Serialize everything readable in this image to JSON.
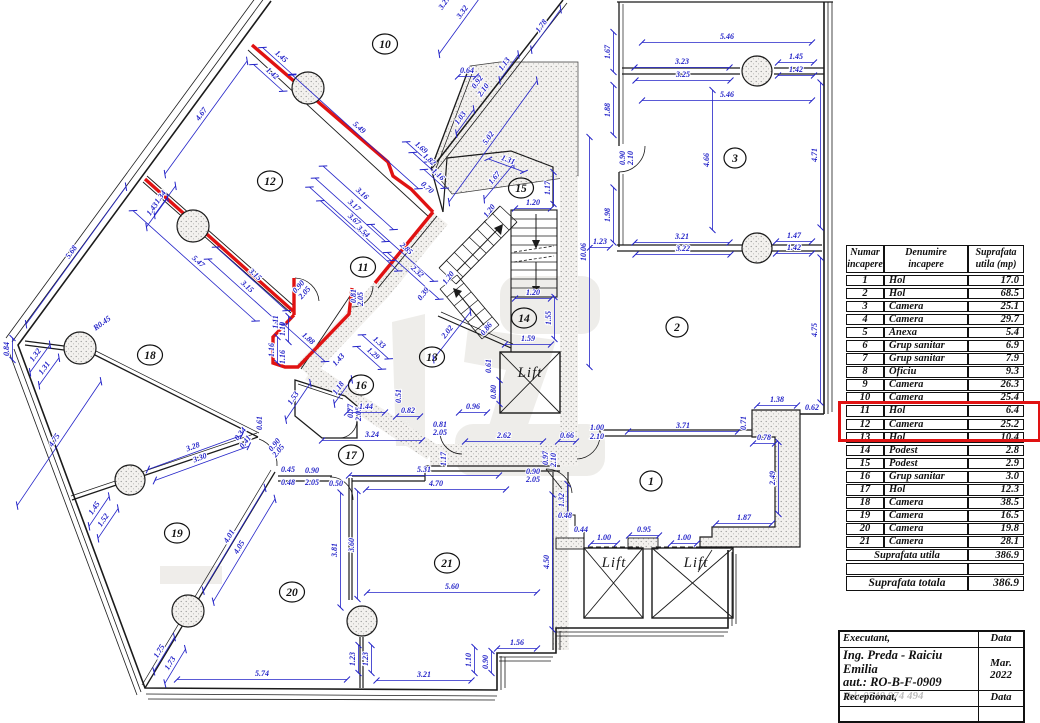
{
  "colors": {
    "wall": "#1b1b1b",
    "dimension_blue": "#2323c8",
    "highlight_red": "#e01212",
    "stipple_gray": "#909090"
  },
  "plan": {
    "rooms": [
      {
        "n": "1",
        "x": 651,
        "y": 481
      },
      {
        "n": "2",
        "x": 677,
        "y": 327
      },
      {
        "n": "3",
        "x": 735,
        "y": 158
      },
      {
        "n": "10",
        "x": 385,
        "y": 44
      },
      {
        "n": "11",
        "x": 363,
        "y": 267
      },
      {
        "n": "12",
        "x": 270,
        "y": 181
      },
      {
        "n": "13",
        "x": 432,
        "y": 357
      },
      {
        "n": "14",
        "x": 524,
        "y": 318
      },
      {
        "n": "15",
        "x": 521,
        "y": 188
      },
      {
        "n": "16",
        "x": 361,
        "y": 385
      },
      {
        "n": "17",
        "x": 351,
        "y": 455
      },
      {
        "n": "18",
        "x": 150,
        "y": 355
      },
      {
        "n": "19",
        "x": 177,
        "y": 533
      },
      {
        "n": "20",
        "x": 292,
        "y": 592
      },
      {
        "n": "21",
        "x": 447,
        "y": 563
      }
    ],
    "lifts": [
      {
        "label": "Lift",
        "x": 530,
        "y": 377
      },
      {
        "label": "Lift",
        "x": 614,
        "y": 567
      },
      {
        "label": "Lift",
        "x": 696,
        "y": 567
      }
    ],
    "dims": [
      {
        "t": "1.45",
        "x": 279,
        "y": 59,
        "r": 42,
        "l": 40
      },
      {
        "t": "1.42",
        "x": 270,
        "y": 76,
        "r": 42,
        "l": 40
      },
      {
        "t": "4.67",
        "x": 204,
        "y": 116,
        "r": -54,
        "l": 140
      },
      {
        "t": "1.34",
        "x": 163,
        "y": 199,
        "r": -54,
        "l": 36
      },
      {
        "t": "1.43",
        "x": 155,
        "y": 211,
        "r": -54,
        "l": 36
      },
      {
        "t": "5.68",
        "x": 74,
        "y": 254,
        "r": -54,
        "l": 170
      },
      {
        "t": "5.49",
        "x": 357,
        "y": 130,
        "r": 42,
        "l": 170
      },
      {
        "t": "3.16",
        "x": 360,
        "y": 196,
        "r": 42,
        "l": 95
      },
      {
        "t": "3.17",
        "x": 352,
        "y": 208,
        "r": 42,
        "l": 95
      },
      {
        "t": "5.47",
        "x": 196,
        "y": 264,
        "r": 42,
        "l": 165
      },
      {
        "t": "3.15",
        "x": 253,
        "y": 277,
        "r": 42,
        "l": 95
      },
      {
        "t": "3.15",
        "x": 245,
        "y": 289,
        "r": 42,
        "l": 95
      },
      {
        "t": "1.32",
        "x": 38,
        "y": 357,
        "r": -54,
        "l": 34
      },
      {
        "t": "1.31",
        "x": 47,
        "y": 370,
        "r": -54,
        "l": 34
      },
      {
        "t": "0.84",
        "x": 10,
        "y": 349,
        "r": -90,
        "l": 22
      },
      {
        "t": "R0.45",
        "x": 104,
        "y": 326,
        "r": -36,
        "l": 0
      },
      {
        "t": "1.69",
        "x": 419,
        "y": 150,
        "r": 42,
        "l": 30
      },
      {
        "t": "1.82",
        "x": 427,
        "y": 162,
        "r": 42,
        "l": 34
      },
      {
        "t": "1.16",
        "x": 436,
        "y": 177,
        "r": 42,
        "l": 28
      },
      {
        "t": "0.70",
        "x": 425,
        "y": 190,
        "r": 42,
        "l": 0
      },
      {
        "t": "3.67",
        "x": 352,
        "y": 222,
        "r": 42,
        "l": 110
      },
      {
        "t": "3.54",
        "x": 361,
        "y": 234,
        "r": 42,
        "l": 105
      },
      {
        "t": "2.85",
        "x": 404,
        "y": 251,
        "r": 42,
        "l": 85
      },
      {
        "t": "2.32",
        "x": 415,
        "y": 274,
        "r": 42,
        "l": 70
      },
      {
        "t": "1.03",
        "x": 463,
        "y": 120,
        "r": -54,
        "l": 30
      },
      {
        "t": "5.02",
        "x": 491,
        "y": 140,
        "r": -54,
        "l": 150
      },
      {
        "t": "0.92",
        "x": 480,
        "y": 84,
        "r": -54,
        "l": 0
      },
      {
        "t": "2.10",
        "x": 486,
        "y": 92,
        "r": -54,
        "l": 0
      },
      {
        "t": "1.13",
        "x": 507,
        "y": 66,
        "r": -54,
        "l": 32
      },
      {
        "t": "1.78",
        "x": 544,
        "y": 28,
        "r": -54,
        "l": 50
      },
      {
        "t": "3.27",
        "x": 447,
        "y": 5,
        "r": -54,
        "l": 0
      },
      {
        "t": "3.32",
        "x": 465,
        "y": 14,
        "r": -54,
        "l": 95
      },
      {
        "t": "0.64",
        "x": 467,
        "y": 74,
        "r": 0,
        "l": 18
      },
      {
        "t": "1.67",
        "x": 497,
        "y": 180,
        "r": -50,
        "l": 46
      },
      {
        "t": "1.31",
        "x": 507,
        "y": 163,
        "r": 20,
        "l": 38
      },
      {
        "t": "1.17",
        "x": 551,
        "y": 188,
        "r": -90,
        "l": 32
      },
      {
        "t": "1.20",
        "x": 533,
        "y": 206,
        "r": 0,
        "l": 36
      },
      {
        "t": "1.20",
        "x": 533,
        "y": 296,
        "r": 0,
        "l": 36
      },
      {
        "t": "1.55",
        "x": 552,
        "y": 318,
        "r": -90,
        "l": 42
      },
      {
        "t": "1.59",
        "x": 528,
        "y": 342,
        "r": 0,
        "l": 46
      },
      {
        "t": "0.86",
        "x": 489,
        "y": 331,
        "r": -52,
        "l": 0
      },
      {
        "t": "2.02",
        "x": 450,
        "y": 334,
        "r": -52,
        "l": 60
      },
      {
        "t": "0.39",
        "x": 426,
        "y": 296,
        "r": -52,
        "l": 0
      },
      {
        "t": "1.20",
        "x": 492,
        "y": 213,
        "r": -52,
        "l": 0
      },
      {
        "t": "1.20",
        "x": 451,
        "y": 280,
        "r": -52,
        "l": 0
      },
      {
        "t": "10.06",
        "x": 587,
        "y": 252,
        "r": -90,
        "l": 230
      },
      {
        "t": "1.23",
        "x": 600,
        "y": 245,
        "r": 0,
        "l": 20
      },
      {
        "t": "0.90",
        "x": 301,
        "y": 289,
        "r": -48,
        "l": 0
      },
      {
        "t": "2.05",
        "x": 307,
        "y": 295,
        "r": -48,
        "l": 0
      },
      {
        "t": "0.81",
        "x": 357,
        "y": 296,
        "r": -90,
        "l": 0
      },
      {
        "t": "2.05",
        "x": 364,
        "y": 299,
        "r": -90,
        "l": 0
      },
      {
        "t": "1.11",
        "x": 279,
        "y": 322,
        "r": -90,
        "l": 0
      },
      {
        "t": "1.10",
        "x": 286,
        "y": 329,
        "r": -90,
        "l": 26
      },
      {
        "t": "1.16",
        "x": 275,
        "y": 350,
        "r": -90,
        "l": 26
      },
      {
        "t": "1.16",
        "x": 286,
        "y": 357,
        "r": -90,
        "l": 0
      },
      {
        "t": "1.88",
        "x": 306,
        "y": 341,
        "r": 42,
        "l": 56
      },
      {
        "t": "1.33",
        "x": 377,
        "y": 345,
        "r": 42,
        "l": 36
      },
      {
        "t": "1.29",
        "x": 371,
        "y": 356,
        "r": 42,
        "l": 34
      },
      {
        "t": "1.43",
        "x": 341,
        "y": 362,
        "r": -48,
        "l": 0
      },
      {
        "t": "1.18",
        "x": 341,
        "y": 390,
        "r": -54,
        "l": 30
      },
      {
        "t": "1.53",
        "x": 296,
        "y": 400,
        "r": -56,
        "l": 44
      },
      {
        "t": "0.51",
        "x": 402,
        "y": 396,
        "r": -90,
        "l": 0
      },
      {
        "t": "0.77",
        "x": 354,
        "y": 411,
        "r": -90,
        "l": 0
      },
      {
        "t": "2.05",
        "x": 362,
        "y": 414,
        "r": -90,
        "l": 0
      },
      {
        "t": "1.44",
        "x": 366,
        "y": 410,
        "r": 0,
        "l": 38
      },
      {
        "t": "0.82",
        "x": 408,
        "y": 414,
        "r": 0,
        "l": 24
      },
      {
        "t": "0.96",
        "x": 473,
        "y": 410,
        "r": 0,
        "l": 28
      },
      {
        "t": "0.80",
        "x": 497,
        "y": 392,
        "r": -90,
        "l": 24
      },
      {
        "t": "0.61",
        "x": 492,
        "y": 366,
        "r": -90,
        "l": 0
      },
      {
        "t": "3.24",
        "x": 372,
        "y": 438,
        "r": 0,
        "l": 100
      },
      {
        "t": "0.81",
        "x": 440,
        "y": 428,
        "r": 0,
        "l": 0
      },
      {
        "t": "2.05",
        "x": 440,
        "y": 436,
        "r": 0,
        "l": 0
      },
      {
        "t": "2.62",
        "x": 504,
        "y": 439,
        "r": 0,
        "l": 78
      },
      {
        "t": "0.66",
        "x": 567,
        "y": 439,
        "r": 0,
        "l": 18
      },
      {
        "t": "1.00",
        "x": 597,
        "y": 431,
        "r": 0,
        "l": 0
      },
      {
        "t": "2.10",
        "x": 597,
        "y": 440,
        "r": 0,
        "l": 0
      },
      {
        "t": "3.71",
        "x": 683,
        "y": 429,
        "r": 0,
        "l": 110
      },
      {
        "t": "0.71",
        "x": 747,
        "y": 423,
        "r": -90,
        "l": 0
      },
      {
        "t": "1.38",
        "x": 777,
        "y": 403,
        "r": 0,
        "l": 40
      },
      {
        "t": "0.62",
        "x": 812,
        "y": 411,
        "r": 0,
        "l": 0
      },
      {
        "t": "0.78",
        "x": 764,
        "y": 441,
        "r": 0,
        "l": 22
      },
      {
        "t": "2.49",
        "x": 776,
        "y": 478,
        "r": -90,
        "l": 72
      },
      {
        "t": "1.87",
        "x": 744,
        "y": 521,
        "r": 0,
        "l": 56
      },
      {
        "t": "5.31",
        "x": 424,
        "y": 473,
        "r": 0,
        "l": 150
      },
      {
        "t": "4.70",
        "x": 436,
        "y": 487,
        "r": 0,
        "l": 140
      },
      {
        "t": "1.17",
        "x": 447,
        "y": 459,
        "r": -90,
        "l": 0
      },
      {
        "t": "0.97",
        "x": 549,
        "y": 458,
        "r": -90,
        "l": 0
      },
      {
        "t": "2.10",
        "x": 557,
        "y": 460,
        "r": -90,
        "l": 0
      },
      {
        "t": "0.90",
        "x": 533,
        "y": 475,
        "r": 0,
        "l": 0
      },
      {
        "t": "2.05",
        "x": 533,
        "y": 483,
        "r": 0,
        "l": 0
      },
      {
        "t": "0.90",
        "x": 312,
        "y": 474,
        "r": 0,
        "l": 0
      },
      {
        "t": "2.05",
        "x": 312,
        "y": 486,
        "r": 0,
        "l": 0
      },
      {
        "t": "0.45",
        "x": 288,
        "y": 473,
        "r": 0,
        "l": 0
      },
      {
        "t": "0.48",
        "x": 288,
        "y": 486,
        "r": 0,
        "l": 0
      },
      {
        "t": "0.50",
        "x": 336,
        "y": 487,
        "r": 0,
        "l": 0
      },
      {
        "t": "0.61",
        "x": 263,
        "y": 423,
        "r": -90,
        "l": 0
      },
      {
        "t": "0.90",
        "x": 277,
        "y": 447,
        "r": -50,
        "l": 0
      },
      {
        "t": "2.05",
        "x": 281,
        "y": 453,
        "r": -50,
        "l": 0
      },
      {
        "t": "0.34",
        "x": 243,
        "y": 436,
        "r": -52,
        "l": 0
      },
      {
        "t": "0.41",
        "x": 248,
        "y": 444,
        "r": -52,
        "l": 0
      },
      {
        "t": "4.75",
        "x": 57,
        "y": 442,
        "r": -56,
        "l": 150
      },
      {
        "t": "1.45",
        "x": 97,
        "y": 510,
        "r": -56,
        "l": 36
      },
      {
        "t": "1.52",
        "x": 106,
        "y": 522,
        "r": -56,
        "l": 36
      },
      {
        "t": "3.28",
        "x": 194,
        "y": 450,
        "r": -20,
        "l": 100
      },
      {
        "t": "3.30",
        "x": 201,
        "y": 461,
        "r": -20,
        "l": 100
      },
      {
        "t": "4.01",
        "x": 232,
        "y": 538,
        "r": -59,
        "l": 120
      },
      {
        "t": "4.05",
        "x": 242,
        "y": 549,
        "r": -59,
        "l": 120
      },
      {
        "t": "1.75",
        "x": 162,
        "y": 653,
        "r": -59,
        "l": 40
      },
      {
        "t": "1.73",
        "x": 173,
        "y": 665,
        "r": -59,
        "l": 40
      },
      {
        "t": "5.74",
        "x": 262,
        "y": 677,
        "r": 0,
        "l": 170
      },
      {
        "t": "3.21",
        "x": 424,
        "y": 678,
        "r": 0,
        "l": 95
      },
      {
        "t": "1.23",
        "x": 356,
        "y": 659,
        "r": -90,
        "l": 28
      },
      {
        "t": "1.23",
        "x": 369,
        "y": 659,
        "r": -90,
        "l": 28
      },
      {
        "t": "3.81",
        "x": 338,
        "y": 550,
        "r": -90,
        "l": 115
      },
      {
        "t": "3.60",
        "x": 355,
        "y": 545,
        "r": -90,
        "l": 108
      },
      {
        "t": "5.60",
        "x": 452,
        "y": 590,
        "r": 0,
        "l": 170
      },
      {
        "t": "4.50",
        "x": 550,
        "y": 562,
        "r": -90,
        "l": 135
      },
      {
        "t": "1.56",
        "x": 517,
        "y": 646,
        "r": 0,
        "l": 40
      },
      {
        "t": "1.10",
        "x": 472,
        "y": 660,
        "r": -90,
        "l": 26
      },
      {
        "t": "0.90",
        "x": 489,
        "y": 662,
        "r": -90,
        "l": 22
      },
      {
        "t": "1.32",
        "x": 565,
        "y": 500,
        "r": -90,
        "l": 32
      },
      {
        "t": "0.48",
        "x": 565,
        "y": 519,
        "r": 0,
        "l": 0
      },
      {
        "t": "0.44",
        "x": 581,
        "y": 533,
        "r": 0,
        "l": 0
      },
      {
        "t": "1.00",
        "x": 604,
        "y": 541,
        "r": 0,
        "l": 26
      },
      {
        "t": "0.95",
        "x": 644,
        "y": 533,
        "r": 0,
        "l": 30
      },
      {
        "t": "1.00",
        "x": 684,
        "y": 541,
        "r": 0,
        "l": 26
      },
      {
        "t": "5.46",
        "x": 727,
        "y": 40,
        "r": 0,
        "l": 170
      },
      {
        "t": "3.23",
        "x": 682,
        "y": 65,
        "r": 0,
        "l": 95
      },
      {
        "t": "3.25",
        "x": 683,
        "y": 78,
        "r": 0,
        "l": 95
      },
      {
        "t": "1.45",
        "x": 796,
        "y": 60,
        "r": 0,
        "l": 36
      },
      {
        "t": "1.42",
        "x": 796,
        "y": 73,
        "r": 0,
        "l": 36
      },
      {
        "t": "5.46",
        "x": 727,
        "y": 98,
        "r": 0,
        "l": 170
      },
      {
        "t": "1.67",
        "x": 611,
        "y": 52,
        "r": -90,
        "l": 40
      },
      {
        "t": "1.88",
        "x": 611,
        "y": 110,
        "r": -90,
        "l": 50
      },
      {
        "t": "1.98",
        "x": 611,
        "y": 215,
        "r": -90,
        "l": 55
      },
      {
        "t": "0.90",
        "x": 626,
        "y": 158,
        "r": -90,
        "l": 0
      },
      {
        "t": "2.10",
        "x": 634,
        "y": 158,
        "r": -90,
        "l": 0
      },
      {
        "t": "4.66",
        "x": 710,
        "y": 160,
        "r": -90,
        "l": 140
      },
      {
        "t": "4.71",
        "x": 818,
        "y": 155,
        "r": -90,
        "l": 145
      },
      {
        "t": "3.21",
        "x": 682,
        "y": 240,
        "r": 0,
        "l": 95
      },
      {
        "t": "3.22",
        "x": 683,
        "y": 252,
        "r": 0,
        "l": 95
      },
      {
        "t": "1.47",
        "x": 794,
        "y": 239,
        "r": 0,
        "l": 36
      },
      {
        "t": "1.42",
        "x": 794,
        "y": 251,
        "r": 0,
        "l": 36
      },
      {
        "t": "4.75",
        "x": 818,
        "y": 330,
        "r": -90,
        "l": 145
      }
    ]
  },
  "table": {
    "headers": {
      "col1": [
        "Numar",
        "incapere"
      ],
      "col2": [
        "Denumire",
        "incapere"
      ],
      "col3": [
        "Suprafata",
        "utila (mp)"
      ]
    },
    "rows": [
      {
        "num": "1",
        "name": "Hol",
        "area": "17.0"
      },
      {
        "num": "2",
        "name": "Hol",
        "area": "68.5"
      },
      {
        "num": "3",
        "name": "Camera",
        "area": "25.1"
      },
      {
        "num": "4",
        "name": "Camera",
        "area": "29.7"
      },
      {
        "num": "5",
        "name": "Anexa",
        "area": "5.4"
      },
      {
        "num": "6",
        "name": "Grup sanitar",
        "area": "6.9"
      },
      {
        "num": "7",
        "name": "Grup sanitar",
        "area": "7.9"
      },
      {
        "num": "8",
        "name": "Oficiu",
        "area": "9.3"
      },
      {
        "num": "9",
        "name": "Camera",
        "area": "26.3"
      },
      {
        "num": "10",
        "name": "Camera",
        "area": "25.4"
      },
      {
        "num": "11",
        "name": "Hol",
        "area": "6.4"
      },
      {
        "num": "12",
        "name": "Camera",
        "area": "25.2"
      },
      {
        "num": "13",
        "name": "Hol",
        "area": "10.4"
      },
      {
        "num": "14",
        "name": "Podest",
        "area": "2.8"
      },
      {
        "num": "15",
        "name": "Podest",
        "area": "2.9"
      },
      {
        "num": "16",
        "name": "Grup sanitar",
        "area": "3.0"
      },
      {
        "num": "17",
        "name": "Hol",
        "area": "12.3"
      },
      {
        "num": "18",
        "name": "Camera",
        "area": "38.5"
      },
      {
        "num": "19",
        "name": "Camera",
        "area": "16.5"
      },
      {
        "num": "20",
        "name": "Camera",
        "area": "19.8"
      },
      {
        "num": "21",
        "name": "Camera",
        "area": "28.1"
      }
    ],
    "highlight_rows": [
      "11",
      "12"
    ],
    "sum_utila_label": "Suprafata utila",
    "sum_utila_value": "386.9",
    "total_label": "Suprafata totala",
    "total_value": "386.9"
  },
  "title_block": {
    "executant_label": "Executant,",
    "data_label_top": "Data",
    "executant_name": "Ing. Preda - Raiciu Emilia",
    "executant_aut": "aut.: RO-B-F-0909",
    "executant_tel": "Tel: 0740 974 494",
    "date_line1": "Mar.",
    "date_line2": "2022",
    "receptionat_label": "Receptionat,",
    "data_label_bottom": "Data"
  }
}
